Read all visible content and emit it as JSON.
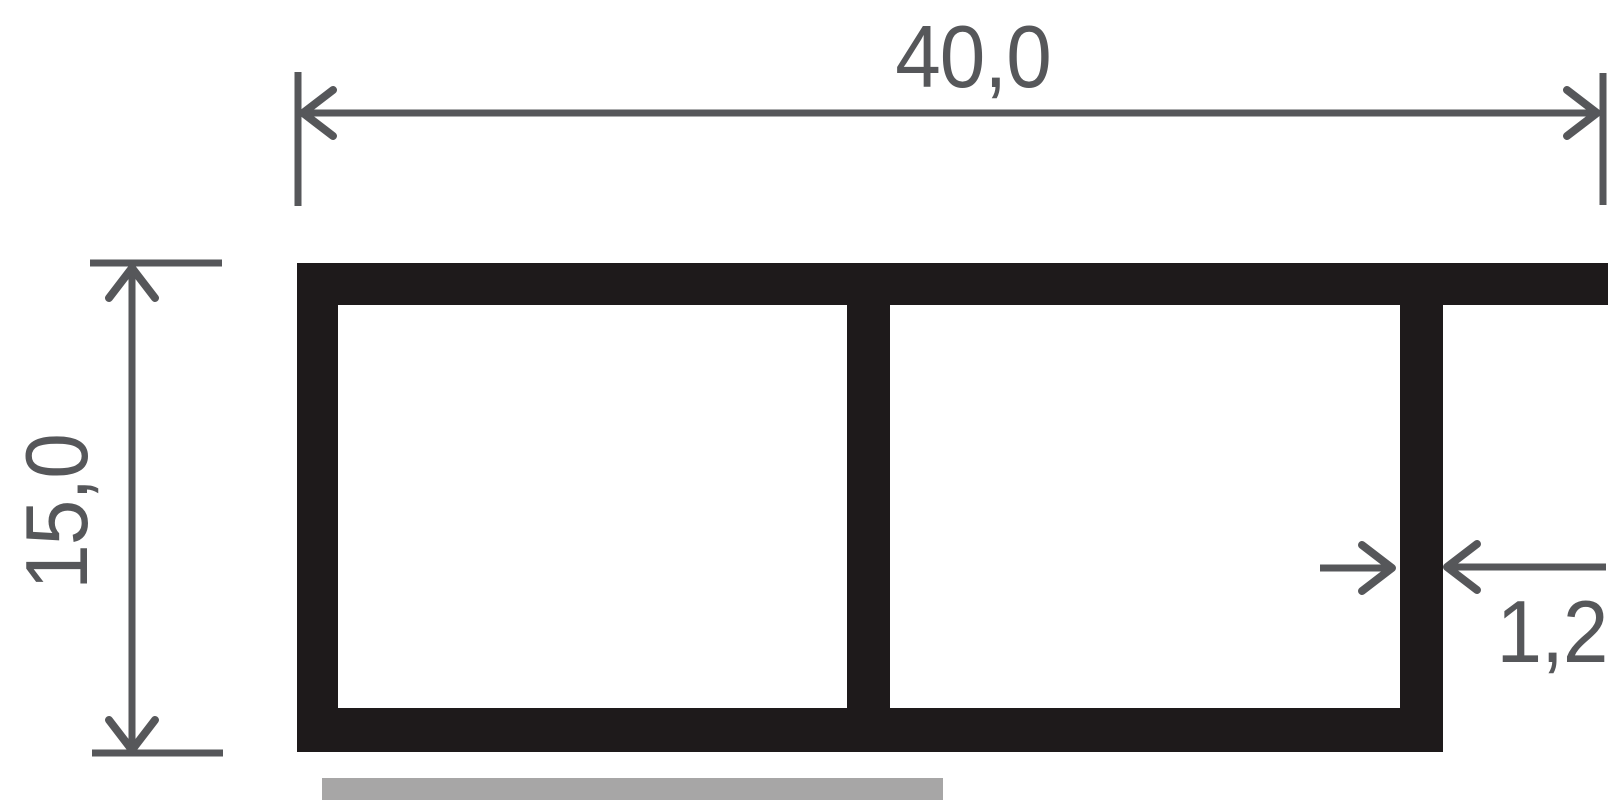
{
  "drawing": {
    "labels": {
      "width": "40,0",
      "height": "15,0",
      "wall_thickness": "1,2"
    },
    "colors": {
      "profile": "#1e1a1b",
      "dimension": "#56575a",
      "ground_bar": "#a7a6a6",
      "background": "#ffffff"
    }
  }
}
